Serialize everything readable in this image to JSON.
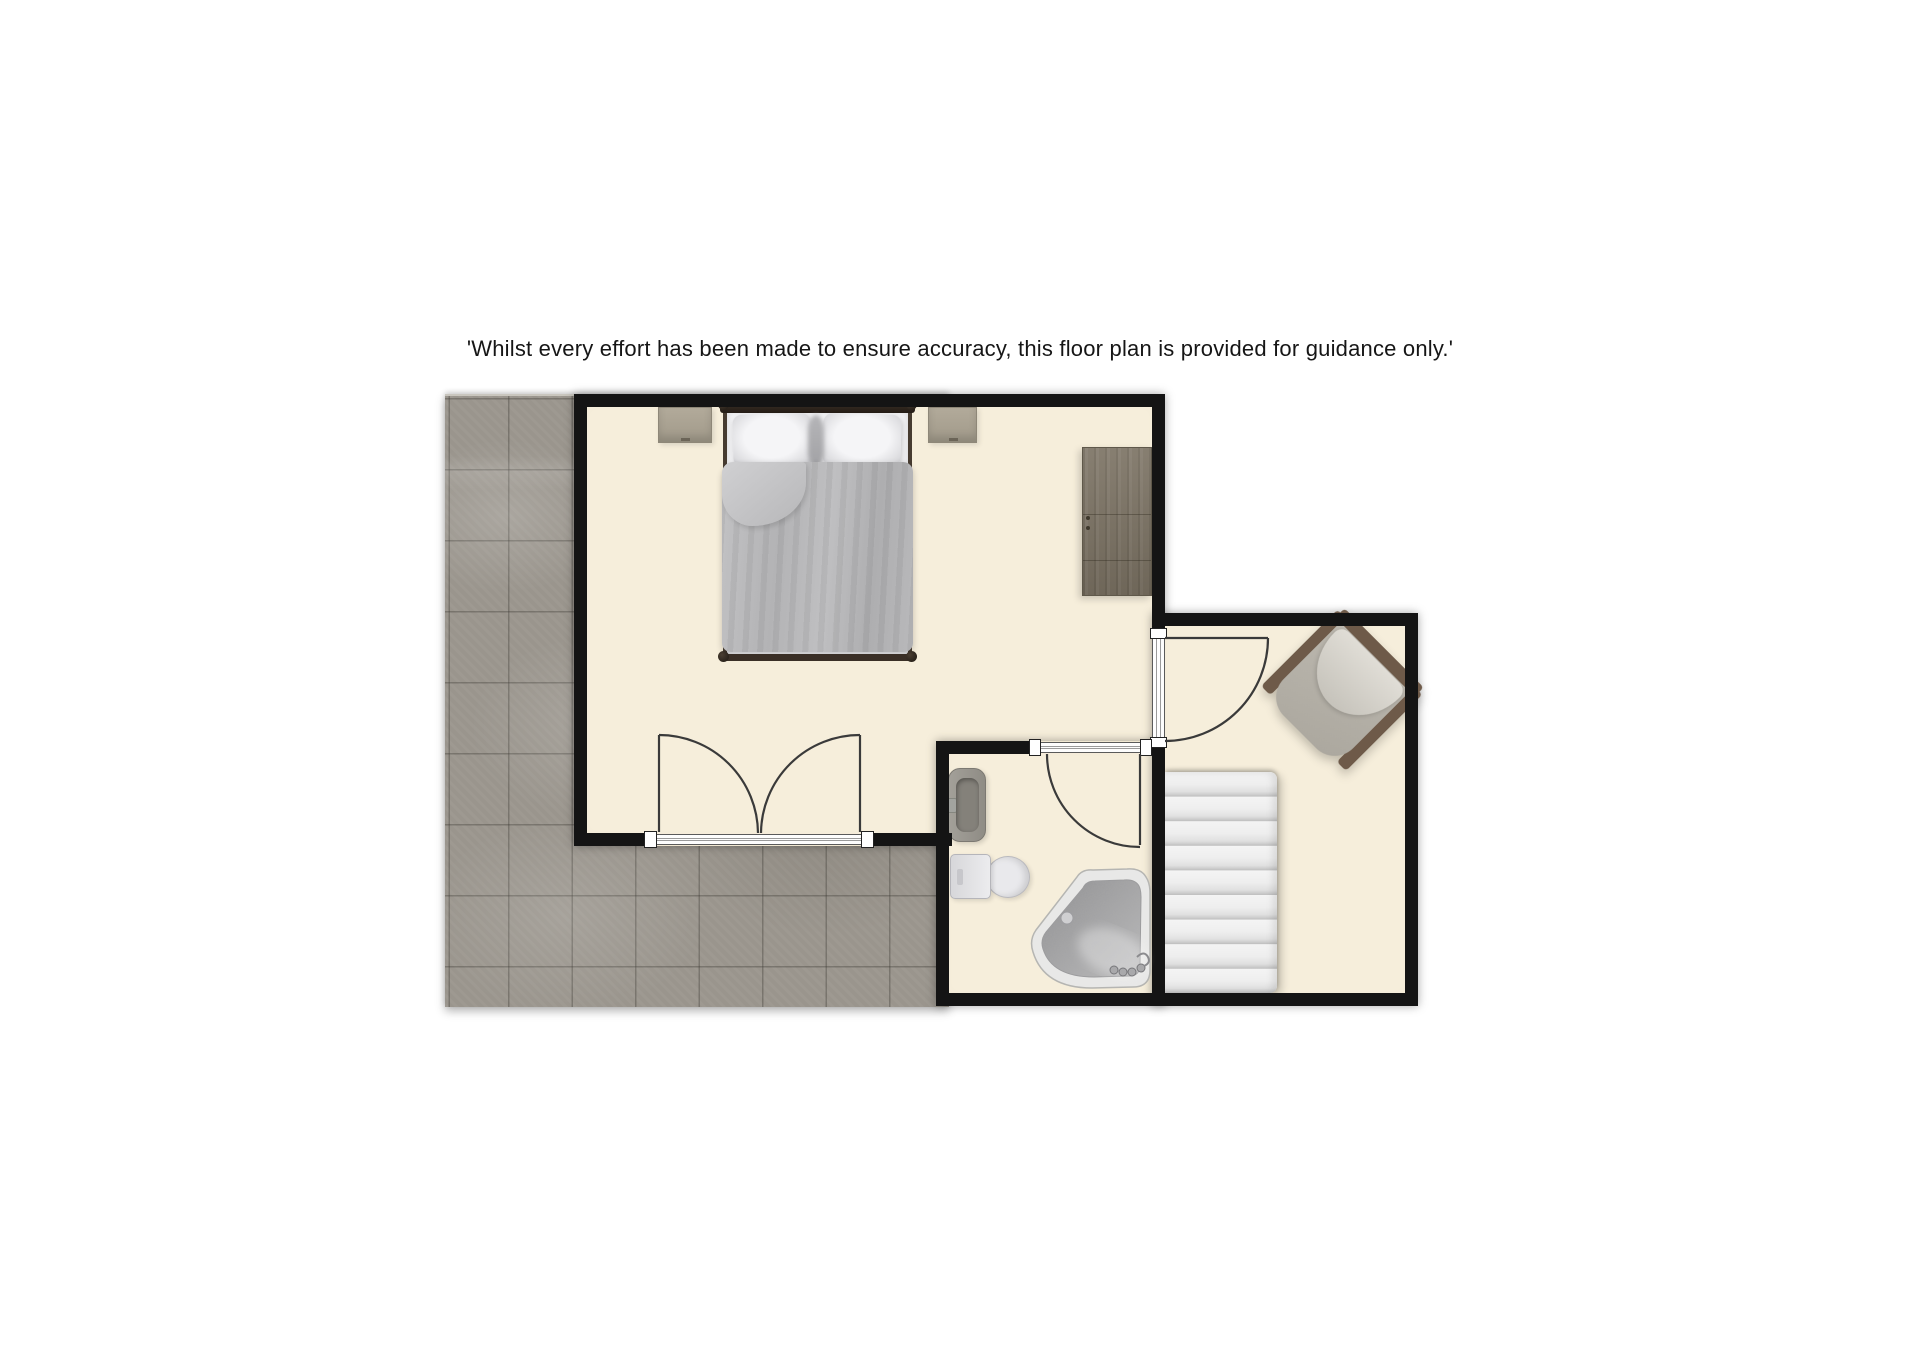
{
  "disclaimer": {
    "text": "'Whilst every effort has been made to ensure accuracy, this floor plan is provided for guidance only.'"
  },
  "palette": {
    "background": "#ffffff",
    "wall": "#141414",
    "room_floor": "#f6eedb",
    "terrace_tile": "#9a958d",
    "wardrobe_wood": "#7b7263",
    "chair_frame": "#6e5a49",
    "chair_cushion": "#d9d6cf",
    "bed_duvet": "#b6b6b8",
    "bed_headboard": "#2f2620",
    "nightstand": "#a89f8f",
    "stairs_step": "#ececec",
    "sink_gray": "#9a968e",
    "toilet_white": "#e9e9ec",
    "bath_rim": "#e8e8e7",
    "bath_basin": "#9f9fa0",
    "door_line": "#3a3a3a"
  }
}
